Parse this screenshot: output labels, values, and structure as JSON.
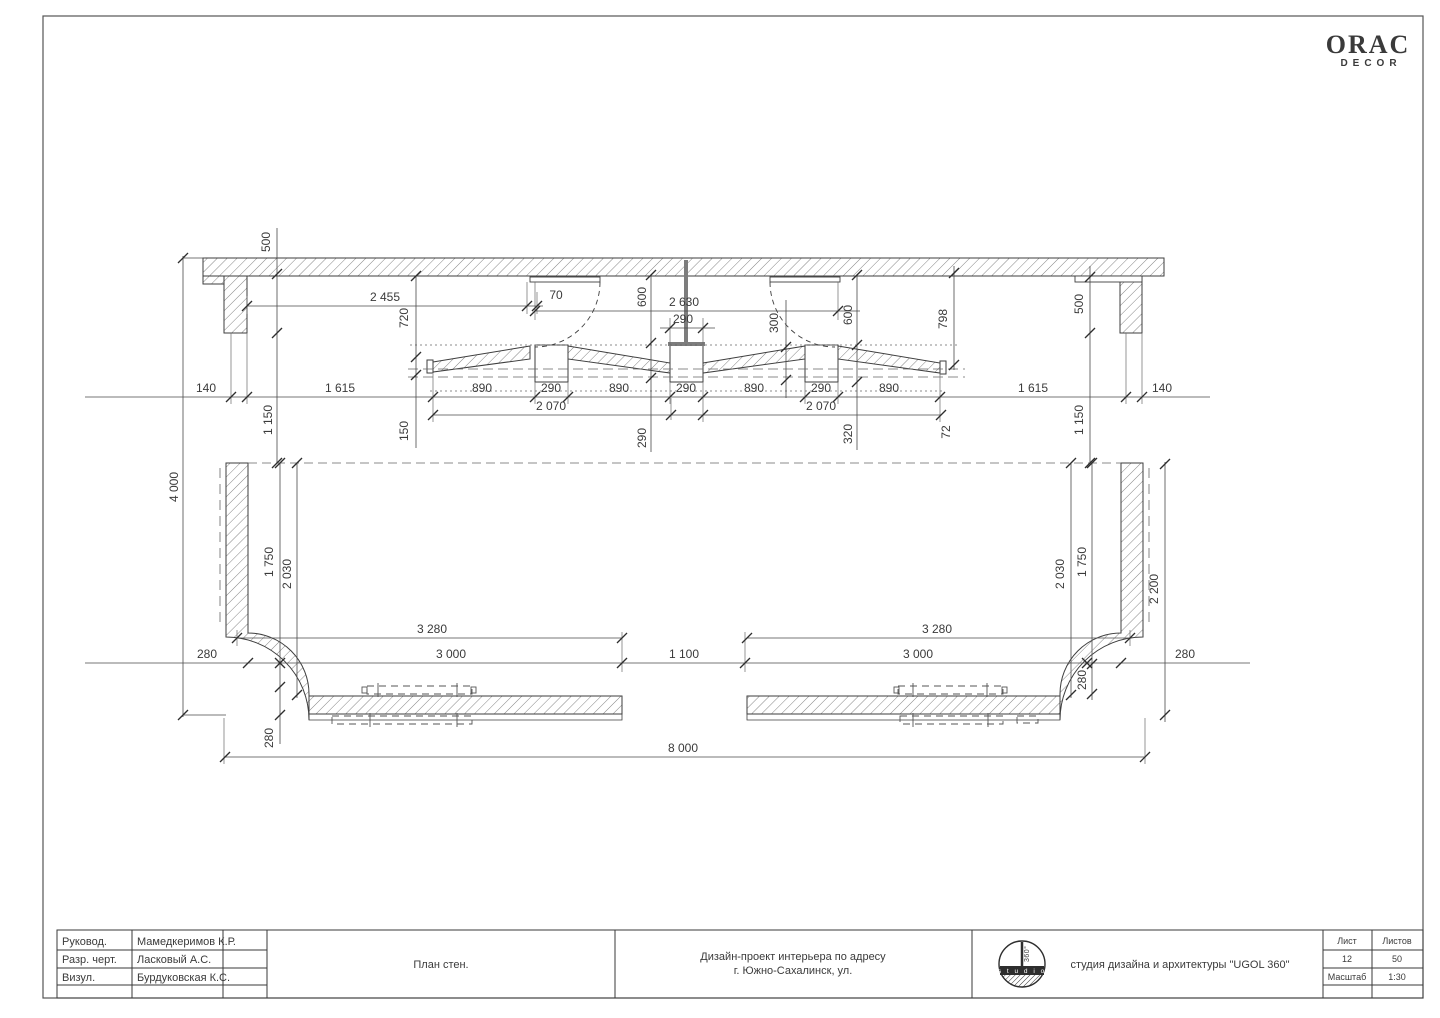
{
  "brand": {
    "name": "ORAC",
    "sub": "DECOR"
  },
  "title_block": {
    "rows": [
      {
        "label": "Руковод.",
        "value": "Мамедкеримов К.Р."
      },
      {
        "label": "Разр. черт.",
        "value": "Ласковый А.С."
      },
      {
        "label": "Визул.",
        "value": "Бурдуковская К.С."
      }
    ],
    "drawing_title": "План стен.",
    "project_line1": "Дизайн-проект интерьера по адресу",
    "project_line2": "г. Южно-Сахалинск, ул.",
    "studio": "студия дизайна и архитектуры \"UGOL 360\"",
    "stamp_studio": "s t u d i o",
    "stamp_360": "360°",
    "sheet_label": "Лист",
    "sheets_label": "Листов",
    "sheet_number": "12",
    "sheets_total": "50",
    "scale_label": "Масштаб",
    "scale_value": "1:30"
  },
  "drawing": {
    "kind": "wall plan, scale 1:30, dimensions in mm",
    "overall": {
      "width_mm": "8 000",
      "height_mm": "4 000"
    },
    "colors": {
      "line": "#3e3e3e",
      "dim": "#4a4a4a",
      "hatch": "#777777",
      "column": "#7d7d7d"
    },
    "dimensions": [
      {
        "t": "500",
        "x": 270,
        "y": 242,
        "r": 1
      },
      {
        "t": "2 455",
        "x": 385,
        "y": 301
      },
      {
        "t": "70",
        "x": 556,
        "y": 299
      },
      {
        "t": "720",
        "x": 408,
        "y": 318,
        "r": 1
      },
      {
        "t": "600",
        "x": 646,
        "y": 297,
        "r": 1
      },
      {
        "t": "2 630",
        "x": 684,
        "y": 306
      },
      {
        "t": "290",
        "x": 683,
        "y": 323
      },
      {
        "t": "300",
        "x": 778,
        "y": 323,
        "r": 1
      },
      {
        "t": "600",
        "x": 852,
        "y": 315,
        "r": 1
      },
      {
        "t": "798",
        "x": 947,
        "y": 319,
        "r": 1
      },
      {
        "t": "500",
        "x": 1083,
        "y": 304,
        "r": 1
      },
      {
        "t": "140",
        "x": 206,
        "y": 392
      },
      {
        "t": "1 615",
        "x": 340,
        "y": 392
      },
      {
        "t": "890",
        "x": 482,
        "y": 392
      },
      {
        "t": "290",
        "x": 551,
        "y": 392
      },
      {
        "t": "890",
        "x": 619,
        "y": 392
      },
      {
        "t": "290",
        "x": 686,
        "y": 392
      },
      {
        "t": "890",
        "x": 754,
        "y": 392
      },
      {
        "t": "290",
        "x": 821,
        "y": 392
      },
      {
        "t": "890",
        "x": 889,
        "y": 392
      },
      {
        "t": "1 615",
        "x": 1033,
        "y": 392
      },
      {
        "t": "140",
        "x": 1162,
        "y": 392
      },
      {
        "t": "2 070",
        "x": 551,
        "y": 410
      },
      {
        "t": "2 070",
        "x": 821,
        "y": 410
      },
      {
        "t": "1 150",
        "x": 272,
        "y": 420,
        "r": 1
      },
      {
        "t": "150",
        "x": 408,
        "y": 431,
        "r": 1
      },
      {
        "t": "290",
        "x": 646,
        "y": 438,
        "r": 1
      },
      {
        "t": "320",
        "x": 852,
        "y": 434,
        "r": 1
      },
      {
        "t": "72",
        "x": 950,
        "y": 432,
        "r": 1
      },
      {
        "t": "1 150",
        "x": 1083,
        "y": 420,
        "r": 1
      },
      {
        "t": "4 000",
        "x": 178,
        "y": 487,
        "r": 1
      },
      {
        "t": "1 750",
        "x": 273,
        "y": 562,
        "r": 1
      },
      {
        "t": "2 030",
        "x": 291,
        "y": 574,
        "r": 1
      },
      {
        "t": "2 030",
        "x": 1064,
        "y": 574,
        "r": 1
      },
      {
        "t": "1 750",
        "x": 1086,
        "y": 562,
        "r": 1
      },
      {
        "t": "2 200",
        "x": 1158,
        "y": 589,
        "r": 1
      },
      {
        "t": "3 280",
        "x": 432,
        "y": 633
      },
      {
        "t": "3 280",
        "x": 937,
        "y": 633
      },
      {
        "t": "280",
        "x": 207,
        "y": 658
      },
      {
        "t": "3 000",
        "x": 451,
        "y": 658
      },
      {
        "t": "1 100",
        "x": 684,
        "y": 658
      },
      {
        "t": "3 000",
        "x": 918,
        "y": 658
      },
      {
        "t": "280",
        "x": 1185,
        "y": 658
      },
      {
        "t": "280",
        "x": 1086,
        "y": 680,
        "r": 1
      },
      {
        "t": "280",
        "x": 273,
        "y": 738,
        "r": 1
      },
      {
        "t": "8 000",
        "x": 683,
        "y": 752
      }
    ]
  }
}
